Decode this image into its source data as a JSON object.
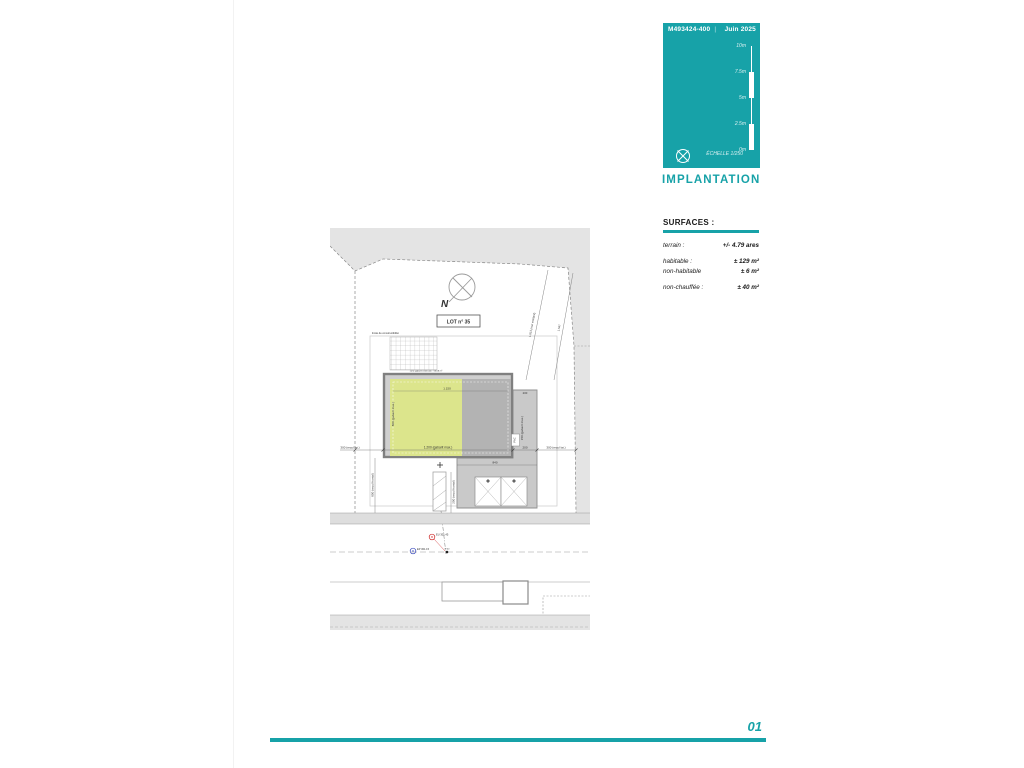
{
  "titleblock": {
    "ref": "M493424-400",
    "separator": "|",
    "date": "Juin 2025",
    "scale_ticks": [
      "10m",
      "7.5m",
      "5m",
      "2.5m",
      "0m"
    ],
    "echelle_label": "ÉCHELLE",
    "echelle_value": "1/250",
    "accent_color": "#17a2a8"
  },
  "sheet_title": "IMPLANTATION",
  "surfaces": {
    "heading": "SURFACES :",
    "rows": [
      {
        "label": "terrain :",
        "value": "+/- 4.79 ares"
      },
      {
        "label": "habitable :",
        "value": "± 129 m²"
      },
      {
        "label": "non-habitable",
        "value": "± 6 m²"
      },
      {
        "label": "non-chauffée :",
        "value": "± 40 m²"
      }
    ]
  },
  "plan": {
    "lot_label": "LOT n° 35",
    "north_letter": "N",
    "zone_note": "limite de constructibilité",
    "extension_note": "zone gabarit extension : 53.08 m²",
    "dims": {
      "top_width": "1.150",
      "bottom_width": "1.200 (gabarit max.)",
      "left_height": "800 (gabarit max.)",
      "right_height": "150 (gabarit max.)",
      "gap_right": "200",
      "ext_top": "200",
      "recul_lat_left": "300 (recul lat.)",
      "recul_lat_right": "300 (recul lat.)",
      "recul_frontal_left": "800 (recul frontal)",
      "recul_frontal_mid": "200 (recul frontal)",
      "carport_width": "840",
      "wall_existing": "1.813 (mur existant)",
      "wall_secondary": "1.547"
    },
    "labels": {
      "pac": "PAC"
    },
    "utilities": {
      "red": "EU 301.45",
      "blue": "EP 301.15",
      "black": "Ø 40"
    }
  },
  "footer": {
    "page_number": "01"
  }
}
